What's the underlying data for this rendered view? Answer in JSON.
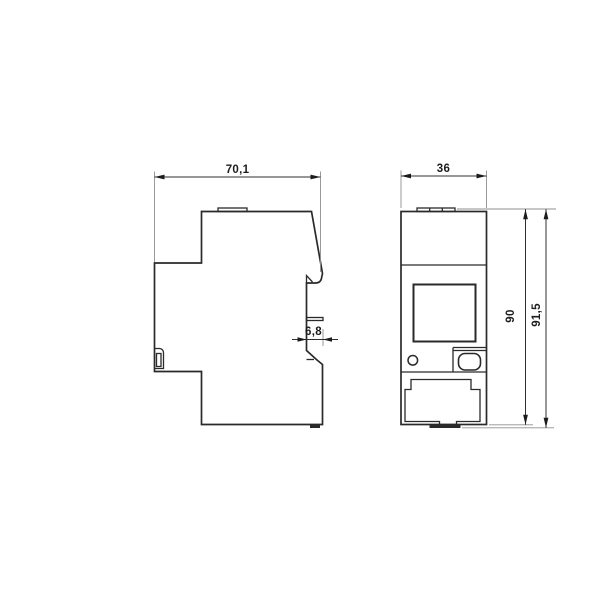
{
  "drawing": {
    "type": "technical-dimension-drawing",
    "background_color": "#ffffff",
    "line_color": "#2a2a2a",
    "extension_line_color": "#8f8f8f",
    "views": [
      {
        "id": "side-profile-view",
        "description": "device side profile with DIN-rail clip"
      },
      {
        "id": "front-view",
        "description": "device front face with display window, indicator, button and terminal cover"
      }
    ],
    "dims": {
      "side_width": "70,1",
      "front_width": "36",
      "recess_depth": "6,8",
      "body_height": "90",
      "overall_height": "91,5"
    }
  }
}
